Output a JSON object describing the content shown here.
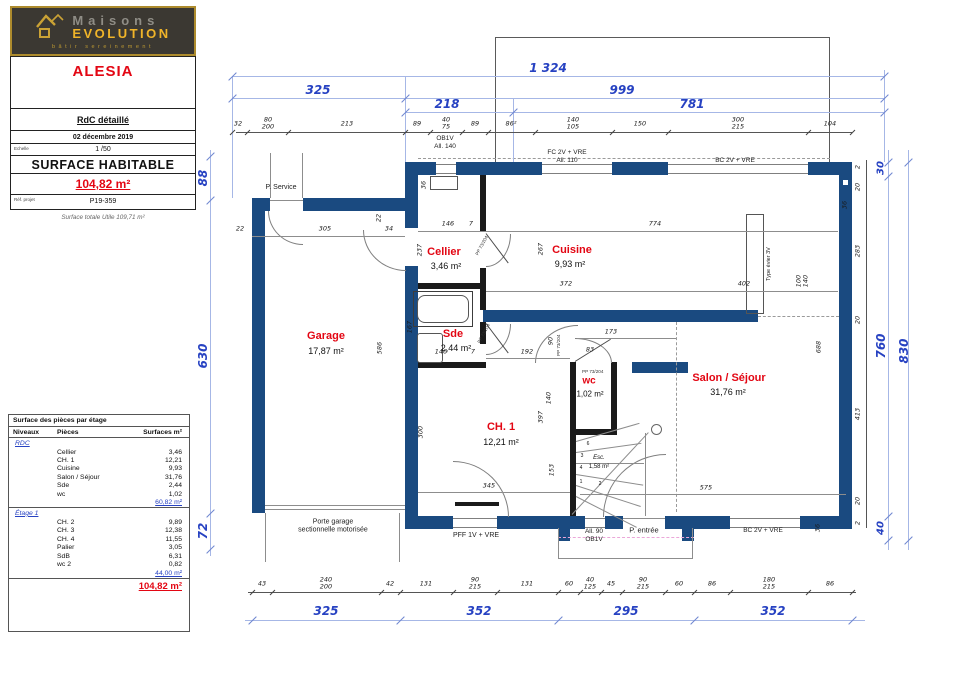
{
  "logo": {
    "brand_top": "Maisons",
    "brand_bottom": "EVOLUTION",
    "tagline": "bâtir sereinement"
  },
  "title_block": {
    "project": "ALESIA",
    "drawing": "RdC détaillé",
    "date": "02 décembre 2019",
    "scale_label": "Echelle",
    "scale": "1 /50",
    "surface_label": "SURFACE HABITABLE",
    "surface_value": "104,82 m²",
    "ref_label": "Réf. projet",
    "ref_value": "P19-359",
    "note": "Surface totale Utile 109,71 m²"
  },
  "areas_table": {
    "title": "Surface des pièces par étage",
    "headers": [
      "Niveaux",
      "Pièces",
      "Surfaces m²"
    ],
    "levels": [
      {
        "name": "RDC",
        "rows": [
          [
            "Cellier",
            "3,46"
          ],
          [
            "CH. 1",
            "12,21"
          ],
          [
            "Cuisine",
            "9,93"
          ],
          [
            "Salon / Séjour",
            "31,76"
          ],
          [
            "Sde",
            "2,44"
          ],
          [
            "wc",
            "1,02"
          ]
        ],
        "subtotal": "60,82 m²"
      },
      {
        "name": "Étage 1",
        "rows": [
          [
            "CH. 2",
            "9,89"
          ],
          [
            "CH. 3",
            "12,38"
          ],
          [
            "CH. 4",
            "11,55"
          ],
          [
            "Palier",
            "3,05"
          ],
          [
            "SdB",
            "6,31"
          ],
          [
            "wc 2",
            "0,82"
          ]
        ],
        "subtotal": "44,00 m²"
      }
    ],
    "total": "104,82 m²"
  },
  "plan": {
    "rooms": [
      {
        "name": "Garage",
        "area": "17,87 m²"
      },
      {
        "name": "Cellier",
        "area": "3,46 m²"
      },
      {
        "name": "Cuisine",
        "area": "9,93 m²"
      },
      {
        "name": "Sde",
        "area": "2,44 m²"
      },
      {
        "name": "wc",
        "area": "1,02 m²"
      },
      {
        "name": "CH. 1",
        "area": "12,21 m²"
      },
      {
        "name": "Salon / Séjour",
        "area": "31,76 m²"
      }
    ],
    "stair": {
      "label": "Esc.",
      "area": "1,58 m²",
      "steps": [
        "1",
        "2",
        "3",
        "4",
        "6"
      ]
    },
    "labels": {
      "p_service": "P. Service",
      "ob1v_top": "OB1V\nAll. 140",
      "fc": "FC 2V + VRE\nAll. 110",
      "bc_top": "BC 2V + VRE",
      "evier": "Type évier 3V",
      "pff": "PFF 1V + VRE",
      "all90": "All. 90\nOB1V",
      "entree": "P. entrée",
      "bc_bottom": "BC 2V + VRE",
      "garage_door": "Porte garage\nsectionnelle motorisée",
      "pp1": "PP 73/204",
      "pp2": "PP 73/204",
      "pp3": "PP 73/204",
      "pp4": "PP 73/204"
    },
    "top_blue": [
      "1 324",
      "325",
      "999",
      "218",
      "781"
    ],
    "top_small": [
      "32",
      "80\n200",
      "213",
      "89",
      "40\n75",
      "89",
      "86²",
      "140\n105",
      "150",
      "300\n215",
      "104"
    ],
    "bottom_blue": [
      "325",
      "352",
      "295",
      "352"
    ],
    "bottom_small": [
      "43",
      "240\n200",
      "42",
      "131",
      "90\n215",
      "131",
      "60",
      "40\n125",
      "45",
      "90\n215",
      "60",
      "86",
      "180\n215",
      "86"
    ],
    "left_blue": [
      "88",
      "630",
      "72"
    ],
    "right_blue": [
      "30",
      "760",
      "830",
      "40"
    ],
    "right_small": [
      "2",
      "20",
      "283",
      "20",
      "413",
      "20",
      "2"
    ],
    "inner": [
      "22",
      "305",
      "34",
      "22",
      "146",
      "7",
      "774",
      "36",
      "237",
      "267",
      "372",
      "402",
      "100\n140",
      "586",
      "167",
      "192",
      "90",
      "173",
      "83",
      "146",
      "7",
      "300",
      "140",
      "397",
      "153",
      "688",
      "345",
      "575",
      "36",
      "36"
    ]
  }
}
